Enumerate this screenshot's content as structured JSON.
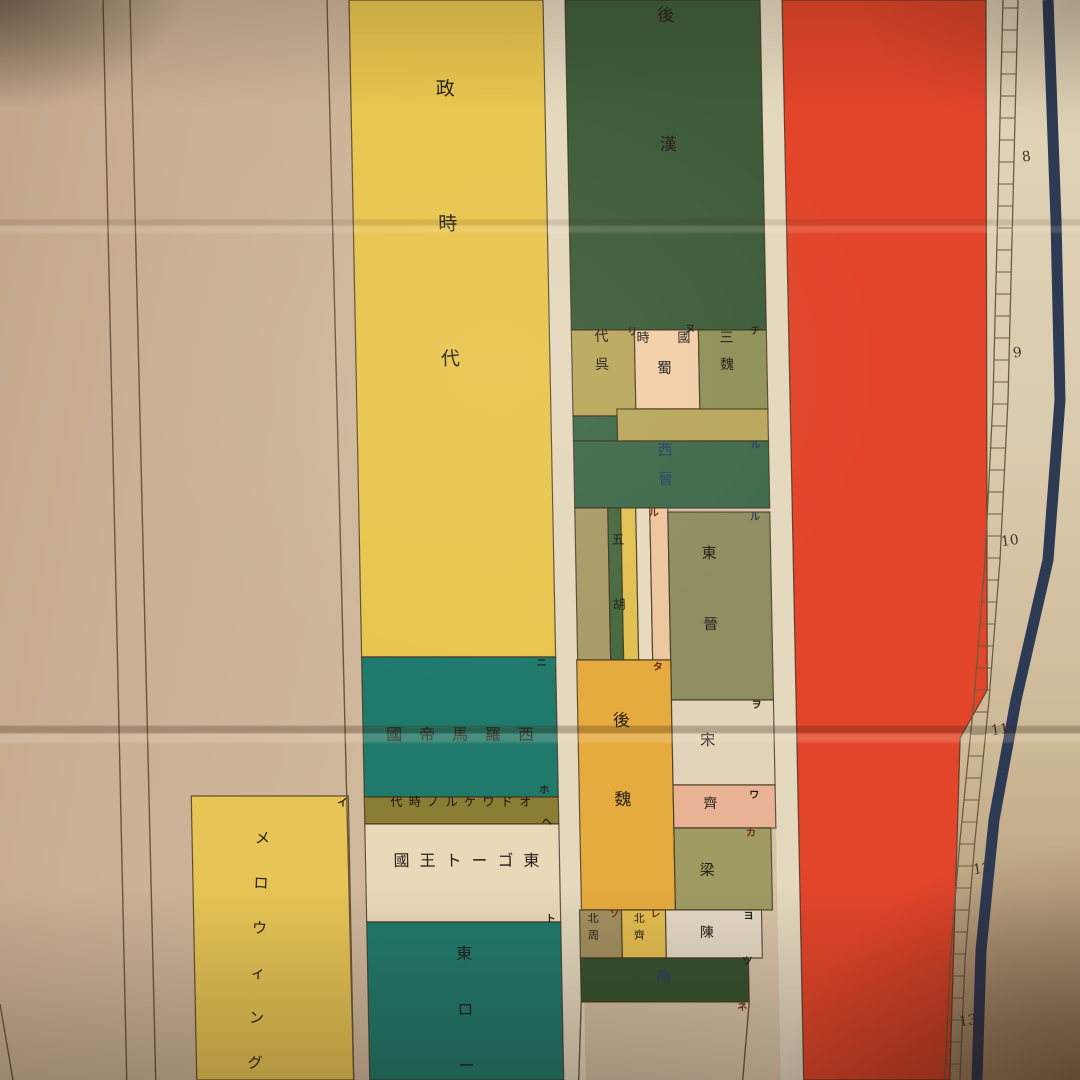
{
  "meta": {
    "description": "Photograph of a paper historical synchronology wall chart with vertical colored era bands and a numbered scale on the right edge"
  },
  "palette": {
    "inkDark": "#26201a",
    "inkBlue": "#2a4167",
    "inkRed": "#6f2a1c",
    "inkBand": "#17150b",
    "yellow": "#e8c54e",
    "teal": "#207a6c",
    "darkGreen": "#3d5c39",
    "oliveYellow": "#b9a75c",
    "peach": "#f1cfa8",
    "oliveGreen": "#8f9158",
    "jinGreen": "#3f6a4b",
    "stripeTan": "#a99b67",
    "stripeGreen": "#486a40",
    "stripeYellow": "#e2c052",
    "stripeCream": "#e9dabf",
    "stripePeach": "#edc79e",
    "eastJin": "#8e8e61",
    "amber": "#e6ab3f",
    "cream": "#e2d3ba",
    "salmon": "#eab294",
    "liangOlive": "#9f9b63",
    "chenCream": "#e5dac6",
    "zhouTan": "#a39060",
    "qiYellow": "#e3be50",
    "suiGreen": "#36532f",
    "red": "#e2452a",
    "navy": "#2d3a54",
    "odoacerBg": "#8b7d33",
    "merovYellow": "#e6c455",
    "gapCream": "#e4d8be",
    "ostroCream": "#ead9b8",
    "blockStroke": "#3f311d",
    "lineBrown": "#6b563c",
    "railBrown": "#6f5c40"
  },
  "chart_data": {
    "type": "timeline",
    "orientation": "vertical-scroll",
    "scale_tick_labels": [
      "8",
      "9",
      "10",
      "11",
      "12",
      "13"
    ],
    "columns": [
      {
        "name": "left-margin-column",
        "eras": []
      },
      {
        "name": "frankish-column",
        "eras": [
          {
            "label": "メロウィング",
            "ref_mark": "イ"
          }
        ]
      },
      {
        "name": "rome-italy-column",
        "eras": [
          {
            "label": "政時代"
          },
          {
            "label": "西羅馬帝國",
            "ref_mark": "ニ"
          },
          {
            "label": "オドワケルノ時代",
            "ref_mark": "ホ"
          },
          {
            "label": "東ゴート王國",
            "ref_mark": "ヘ"
          },
          {
            "label": "東ロー",
            "ref_mark": "ト"
          }
        ]
      },
      {
        "name": "china-column",
        "eras": [
          {
            "label": "後漢"
          },
          {
            "label": "三國時代",
            "kingdoms": [
              {
                "label": "魏",
                "ref_mark": "チ"
              },
              {
                "label": "蜀",
                "ref_mark": "ヌ"
              },
              {
                "label": "呉",
                "ref_mark": "リ"
              }
            ]
          },
          {
            "label": "西晉",
            "ref_mark": "ル"
          },
          {
            "label": "五胡",
            "ref_mark": "ル"
          },
          {
            "label": "東晉",
            "ref_mark": "ル"
          },
          {
            "label": "後魏",
            "ref_mark": "タ"
          },
          {
            "label": "宋",
            "ref_mark": "ヲ"
          },
          {
            "label": "齊",
            "ref_mark": "ワ"
          },
          {
            "label": "梁",
            "ref_mark": "カ"
          },
          {
            "label": "陳",
            "ref_mark": "ヨ"
          },
          {
            "label": "北周",
            "ref_mark": "ソ"
          },
          {
            "label": "北齊",
            "ref_mark": "レ"
          },
          {
            "label": "隋",
            "ref_mark": "ツ"
          },
          {
            "label": "",
            "ref_mark": "ネ"
          }
        ]
      },
      {
        "name": "red-column",
        "eras": []
      }
    ]
  },
  "layout": {
    "skew_deg": 1.1,
    "blocks": [
      {
        "name": "gap-rome-china",
        "x": 543,
        "y": 0,
        "w": 22,
        "h": 1080,
        "fill": "gapCream",
        "noStroke": true
      },
      {
        "name": "gap-china-red",
        "x": 760,
        "y": 0,
        "w": 22,
        "h": 1080,
        "fill": "gapCream",
        "noStroke": true
      },
      {
        "name": "merovingian-block",
        "x": 176,
        "y": 796,
        "w": 157,
        "h": 284,
        "fill": "merovYellow"
      },
      {
        "name": "rome-yellow-block",
        "x": 349,
        "y": 0,
        "w": 194,
        "h": 657,
        "fill": "yellow"
      },
      {
        "name": "west-rome-block",
        "x": 349,
        "y": 657,
        "w": 194,
        "h": 140,
        "fill": "teal"
      },
      {
        "name": "odoacer-band",
        "x": 349,
        "y": 797,
        "w": 194,
        "h": 27,
        "fill": "odoacerBg"
      },
      {
        "name": "ostrogoth-block",
        "x": 349,
        "y": 824,
        "w": 194,
        "h": 98,
        "fill": "ostroCream"
      },
      {
        "name": "east-rome-block",
        "x": 349,
        "y": 922,
        "w": 194,
        "h": 158,
        "fill": "teal"
      },
      {
        "name": "later-han-block",
        "x": 565,
        "y": 0,
        "w": 195,
        "h": 330,
        "fill": "darkGreen"
      },
      {
        "name": "wu-block",
        "x": 565,
        "y": 330,
        "w": 63,
        "h": 86,
        "fill": "oliveYellow"
      },
      {
        "name": "shu-block",
        "x": 628,
        "y": 330,
        "w": 64,
        "h": 79,
        "fill": "peach"
      },
      {
        "name": "wei-block",
        "x": 692,
        "y": 330,
        "w": 68,
        "h": 83,
        "fill": "oliveGreen"
      },
      {
        "name": "wu-tail-band",
        "x": 609,
        "y": 409,
        "w": 151,
        "h": 32,
        "fill": "oliveYellow"
      },
      {
        "name": "west-jin-notch",
        "x": 565,
        "y": 416,
        "w": 44,
        "h": 25,
        "fill": "jinGreen"
      },
      {
        "name": "west-jin-block",
        "x": 565,
        "y": 441,
        "w": 195,
        "h": 67,
        "fill": "jinGreen"
      },
      {
        "name": "five-hu-stripe-1",
        "x": 565,
        "y": 508,
        "w": 33,
        "h": 152,
        "fill": "stripeTan"
      },
      {
        "name": "five-hu-stripe-2",
        "x": 598,
        "y": 508,
        "w": 13,
        "h": 152,
        "fill": "stripeGreen"
      },
      {
        "name": "five-hu-stripe-3",
        "x": 611,
        "y": 508,
        "w": 15,
        "h": 152,
        "fill": "stripeYellow"
      },
      {
        "name": "five-hu-stripe-4",
        "x": 626,
        "y": 508,
        "w": 14,
        "h": 152,
        "fill": "stripeCream"
      },
      {
        "name": "five-hu-stripe-5",
        "x": 640,
        "y": 508,
        "w": 18,
        "h": 152,
        "fill": "stripePeach"
      },
      {
        "name": "east-jin-block",
        "x": 658,
        "y": 512,
        "w": 102,
        "h": 188,
        "fill": "eastJin"
      },
      {
        "name": "later-wei-block",
        "x": 564,
        "y": 660,
        "w": 94,
        "h": 250,
        "fill": "amber"
      },
      {
        "name": "song-block",
        "x": 658,
        "y": 700,
        "w": 102,
        "h": 85,
        "fill": "cream"
      },
      {
        "name": "qi-block",
        "x": 658,
        "y": 785,
        "w": 102,
        "h": 43,
        "fill": "salmon"
      },
      {
        "name": "liang-block",
        "x": 658,
        "y": 828,
        "w": 97,
        "h": 82,
        "fill": "liangOlive"
      },
      {
        "name": "north-zhou-block",
        "x": 562,
        "y": 910,
        "w": 42,
        "h": 48,
        "fill": "zhouTan"
      },
      {
        "name": "north-qi-block",
        "x": 604,
        "y": 910,
        "w": 44,
        "h": 48,
        "fill": "qiYellow"
      },
      {
        "name": "chen-block",
        "x": 648,
        "y": 910,
        "w": 96,
        "h": 48,
        "fill": "chenCream"
      },
      {
        "name": "sui-block",
        "x": 562,
        "y": 958,
        "w": 168,
        "h": 44,
        "fill": "suiGreen"
      },
      {
        "name": "red-column",
        "poly": [
          [
            782,
            0
          ],
          [
            986,
            0
          ],
          [
            974,
            690
          ],
          [
            946,
            738
          ],
          [
            929,
            1080
          ],
          [
            783,
            1080
          ]
        ],
        "fill": "red"
      }
    ],
    "lines": [
      {
        "name": "margin-line-1",
        "x1": 103,
        "y1": 0,
        "x2": 106,
        "y2": 1080,
        "lean": true
      },
      {
        "name": "margin-line-2",
        "x1": 130,
        "y1": 0,
        "x2": 135,
        "y2": 1080,
        "lean": true
      },
      {
        "name": "margin-line-3",
        "x1": 327,
        "y1": 0,
        "x2": 333,
        "y2": 1080,
        "lean": true
      },
      {
        "name": "tang-left-border",
        "x1": 562,
        "y1": 1002,
        "x2": 558,
        "y2": 1080,
        "lean": true
      },
      {
        "name": "tang-right-border",
        "x1": 730,
        "y1": 1002,
        "x2": 722,
        "y2": 1080,
        "lean": true
      },
      {
        "name": "corner-stub-line",
        "x1": 0,
        "y1": 1004,
        "x2": 13,
        "y2": 1080,
        "lean": false
      }
    ],
    "texts": [
      {
        "name": "label-seiji-jidai",
        "chars": "政時代",
        "x": 434,
        "y": 80,
        "size": 19,
        "gap": 116,
        "dir": "v",
        "color": "inkDark"
      },
      {
        "name": "label-west-rome",
        "chars": "西羅馬帝國",
        "x": 372,
        "y": 727,
        "width": 148,
        "size": 16,
        "dir": "rtl",
        "color": "inkDark"
      },
      {
        "name": "label-odoacer",
        "chars": "オドワケルノ時代",
        "x": 375,
        "y": 796,
        "width": 141,
        "size": 12,
        "dir": "rtl",
        "color": "inkBand"
      },
      {
        "name": "label-ostrogoth",
        "chars": "東ゴート王國",
        "x": 377,
        "y": 853,
        "width": 146,
        "size": 16,
        "dir": "rtl",
        "color": "inkDark"
      },
      {
        "name": "label-east-rome",
        "chars": "東ロー",
        "x": 438,
        "y": 946,
        "size": 16,
        "gap": 40,
        "dir": "v",
        "color": "inkDark"
      },
      {
        "name": "label-later-han",
        "chars": "後漢",
        "x": 657,
        "y": 8,
        "size": 17,
        "gap": 112,
        "dir": "v",
        "color": "inkDark"
      },
      {
        "name": "label-wu",
        "chars": "代呉",
        "x": 588,
        "y": 330,
        "size": 14,
        "gap": 14,
        "dir": "v",
        "color": "inkDark"
      },
      {
        "name": "label-shu-top",
        "chars": "國時",
        "x": 630,
        "y": 332,
        "width": 54,
        "size": 13,
        "dir": "rtl",
        "color": "inkDark"
      },
      {
        "name": "label-shu",
        "chars": "蜀",
        "x": 650,
        "y": 361,
        "size": 15,
        "gap": 0,
        "dir": "v",
        "color": "inkDark"
      },
      {
        "name": "label-wei",
        "chars": "三魏",
        "x": 713,
        "y": 331,
        "size": 14,
        "gap": 13,
        "dir": "v",
        "color": "inkDark"
      },
      {
        "name": "label-west-jin",
        "chars": "西晉",
        "x": 649,
        "y": 443,
        "size": 15,
        "gap": 14,
        "dir": "v",
        "color": "inkBlue"
      },
      {
        "name": "label-five-hu",
        "chars": "五胡",
        "x": 601,
        "y": 534,
        "size": 13,
        "gap": 52,
        "dir": "v",
        "color": "inkDark"
      },
      {
        "name": "label-east-jin",
        "chars": "東晉",
        "x": 691,
        "y": 546,
        "size": 15,
        "gap": 56,
        "dir": "v",
        "color": "inkDark"
      },
      {
        "name": "label-later-wei",
        "chars": "後魏",
        "x": 599,
        "y": 713,
        "size": 17,
        "gap": 62,
        "dir": "v",
        "color": "inkDark"
      },
      {
        "name": "label-song",
        "chars": "宋",
        "x": 686,
        "y": 733,
        "size": 15,
        "gap": 0,
        "dir": "v",
        "color": "inkDark"
      },
      {
        "name": "label-qi",
        "chars": "齊",
        "x": 688,
        "y": 797,
        "size": 14,
        "gap": 0,
        "dir": "v",
        "color": "inkDark"
      },
      {
        "name": "label-liang",
        "chars": "梁",
        "x": 683,
        "y": 863,
        "size": 15,
        "gap": 0,
        "dir": "v",
        "color": "inkDark"
      },
      {
        "name": "label-chen",
        "chars": "陳",
        "x": 682,
        "y": 926,
        "size": 14,
        "gap": 0,
        "dir": "v",
        "color": "inkDark"
      },
      {
        "name": "label-north-zhou",
        "chars": "北周",
        "x": 570,
        "y": 913,
        "size": 11,
        "gap": 6,
        "dir": "v",
        "color": "inkDark"
      },
      {
        "name": "label-north-qi",
        "chars": "北齊",
        "x": 616,
        "y": 913,
        "size": 11,
        "gap": 6,
        "dir": "v",
        "color": "inkDark"
      },
      {
        "name": "label-sui",
        "chars": "隋",
        "x": 638,
        "y": 970,
        "size": 15,
        "gap": 0,
        "dir": "v",
        "color": "inkBlue"
      },
      {
        "name": "label-merovingian",
        "chars": "メロウィング",
        "x": 233,
        "y": 831,
        "size": 15,
        "gap": 30,
        "dir": "v",
        "color": "inkDark",
        "tilt": 3
      }
    ],
    "marks": [
      {
        "char": "イ",
        "x": 322,
        "y": 799,
        "color": "inkDark"
      },
      {
        "char": "ニ",
        "x": 524,
        "y": 659,
        "color": "inkDark"
      },
      {
        "char": "ホ",
        "x": 524,
        "y": 786,
        "color": "inkDark"
      },
      {
        "char": "ヘ",
        "x": 526,
        "y": 818,
        "color": "inkDark"
      },
      {
        "char": "ト",
        "x": 528,
        "y": 915,
        "color": "inkDark"
      },
      {
        "char": "チ",
        "x": 744,
        "y": 327,
        "color": "inkDark"
      },
      {
        "char": "ヌ",
        "x": 679,
        "y": 325,
        "color": "inkDark"
      },
      {
        "char": "リ",
        "x": 621,
        "y": 328,
        "color": "inkDark"
      },
      {
        "char": "ル",
        "x": 742,
        "y": 441,
        "color": "inkBlue"
      },
      {
        "char": "ル",
        "x": 639,
        "y": 509,
        "color": "inkRed"
      },
      {
        "char": "ル",
        "x": 740,
        "y": 513,
        "color": "inkBlue"
      },
      {
        "char": "タ",
        "x": 640,
        "y": 663,
        "color": "inkRed"
      },
      {
        "char": "ヲ",
        "x": 738,
        "y": 701,
        "color": "inkDark"
      },
      {
        "char": "ワ",
        "x": 734,
        "y": 791,
        "color": "inkDark"
      },
      {
        "char": "カ",
        "x": 730,
        "y": 829,
        "color": "inkRed"
      },
      {
        "char": "ヨ",
        "x": 726,
        "y": 912,
        "color": "inkDark"
      },
      {
        "char": "ソ",
        "x": 592,
        "y": 910,
        "color": "inkRed"
      },
      {
        "char": "レ",
        "x": 633,
        "y": 910,
        "color": "inkRed"
      },
      {
        "char": "ツ",
        "x": 724,
        "y": 957,
        "color": "inkDark"
      },
      {
        "char": "ネ",
        "x": 718,
        "y": 1003,
        "color": "inkRed"
      }
    ],
    "ruler": {
      "ladder": {
        "left_rail": [
          [
            1003,
            0
          ],
          [
            998,
            200
          ],
          [
            993,
            400
          ],
          [
            985,
            560
          ],
          [
            974,
            700
          ],
          [
            960,
            840
          ],
          [
            950,
            960
          ],
          [
            945,
            1080
          ]
        ],
        "rail_offset": 15,
        "rung_spacing": 22
      },
      "navy_points": [
        [
          1048,
          0
        ],
        [
          1056,
          220
        ],
        [
          1060,
          400
        ],
        [
          1048,
          560
        ],
        [
          1016,
          700
        ],
        [
          994,
          820
        ],
        [
          981,
          950
        ],
        [
          977,
          1080
        ]
      ],
      "navy_width": 11,
      "numbers": [
        {
          "label": "8",
          "x": 1022,
          "y": 150
        },
        {
          "label": "9",
          "x": 1013,
          "y": 346
        },
        {
          "label": "10",
          "x": 1001,
          "y": 534
        },
        {
          "label": "11",
          "x": 991,
          "y": 723
        },
        {
          "label": "12",
          "x": 973,
          "y": 862
        },
        {
          "label": "13",
          "x": 959,
          "y": 1014
        }
      ]
    }
  }
}
